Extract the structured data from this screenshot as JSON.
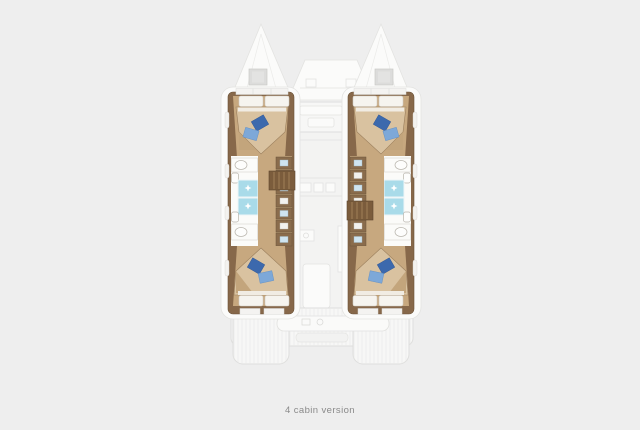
{
  "caption": {
    "text": "4 cabin version"
  },
  "plan": {
    "hull_count": 2,
    "cabin_count": 4,
    "double_bed_count": 4,
    "shower_count": 4,
    "head_count": 4
  },
  "colors": {
    "background": "#eeeeee",
    "hull_wall": "#87684a",
    "wood_floor": "#c7a87f",
    "bed": "#d9c2a0",
    "bed_shadow": "#c3a57c",
    "bed_edge": "#9b7f5d",
    "pillow_white": "#f6f4ef",
    "pillow_blue_dark": "#3c69ad",
    "pillow_blue_light": "#7da8d8",
    "shower": "#a9dbe9",
    "bath_floor": "#fbfbf9",
    "cabinet": "#8a6c4c",
    "step_wood": "#7b5c3c",
    "faded_fill": "#f7f7f6",
    "faded_line": "#dededd",
    "caption": "#8a8a8a"
  }
}
